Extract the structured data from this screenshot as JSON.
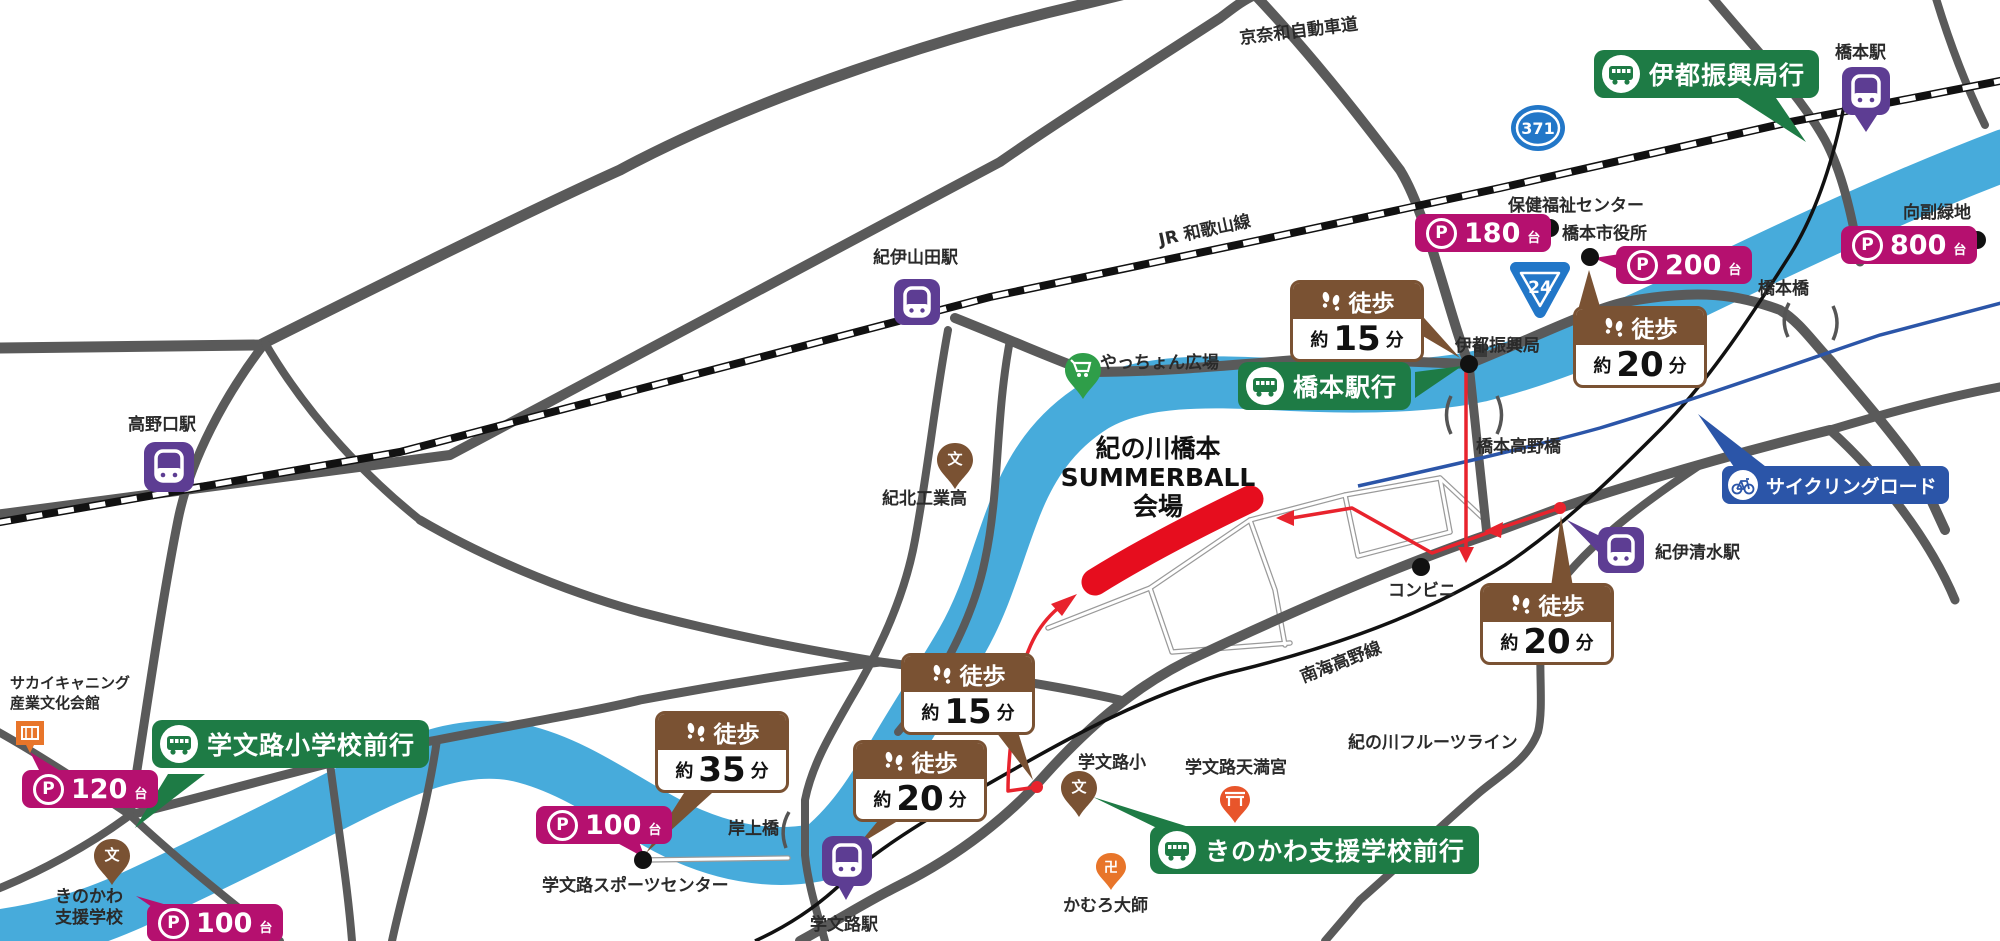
{
  "venue": {
    "line1": "紀の川橋本",
    "line2": "SUMMERBALL",
    "line3": "会場"
  },
  "bus": {
    "ito": "伊都振興局行",
    "hashimoto": "橋本駅行",
    "kamuro": "学文路小学校前行",
    "kinokawa": "きのかわ支援学校前行"
  },
  "walk": {
    "label": "徒歩",
    "about": "約",
    "unit": "分",
    "ito15": "15",
    "shiyakusho20": "20",
    "shimizu20": "20",
    "kamuro15": "15",
    "kamuroeki20": "20",
    "sports35": "35"
  },
  "parking": {
    "letter": "P",
    "unit": "台",
    "hoken": "180",
    "shiyakusho": "200",
    "mukaizoe": "800",
    "sakai": "120",
    "sports": "100",
    "shien": "100"
  },
  "stations": {
    "hashimoto": "橋本駅",
    "kiiyamada": "紀伊山田駅",
    "koyaguchi": "高野口駅",
    "kiishimizu": "紀伊清水駅",
    "kamuro": "学文路駅"
  },
  "roads": {
    "keinawa": "京奈和自動車道",
    "jr": "JR 和歌山線",
    "nankai": "南海高野線",
    "fruit": "紀の川フルーツライン",
    "route371": "371",
    "route24": "24",
    "cycling": "サイクリングロード"
  },
  "river": {
    "kinokawa": "紀の川"
  },
  "bridges": {
    "koya": "橋本高野橋",
    "hashimoto": "橋本橋",
    "kishigami": "岸上橋"
  },
  "poi": {
    "hoken": "保健福祉センター",
    "shiyakusho": "橋本市役所",
    "ito": "伊都振興局",
    "mukaizoe": "向副緑地",
    "yatchon": "やっちょん広場",
    "kihoku": "紀北工業高",
    "conbini": "コンビニ",
    "sakai1": "サカイキャニング",
    "sakai2": "産業文化会館",
    "shien1": "きのかわ",
    "shien2": "支援学校",
    "sports": "学文路スポーツセンター",
    "kamurosho": "学文路小",
    "tenmangu": "学文路天満宮",
    "daishi": "かむろ大師"
  },
  "glyphs": {
    "school": "文",
    "manji": "卍"
  },
  "colors": {
    "bus_green": "#1e7b45",
    "parking_magenta": "#b5106f",
    "walk_brown": "#7a5233",
    "station_purple": "#5d3d93",
    "cycling_blue": "#2b55a8",
    "shield_blue": "#2277c8",
    "river_blue": "#47abdb",
    "road_gray": "#5a5a5a",
    "route_red": "#e8232d",
    "venue_red": "#e60d1e"
  }
}
